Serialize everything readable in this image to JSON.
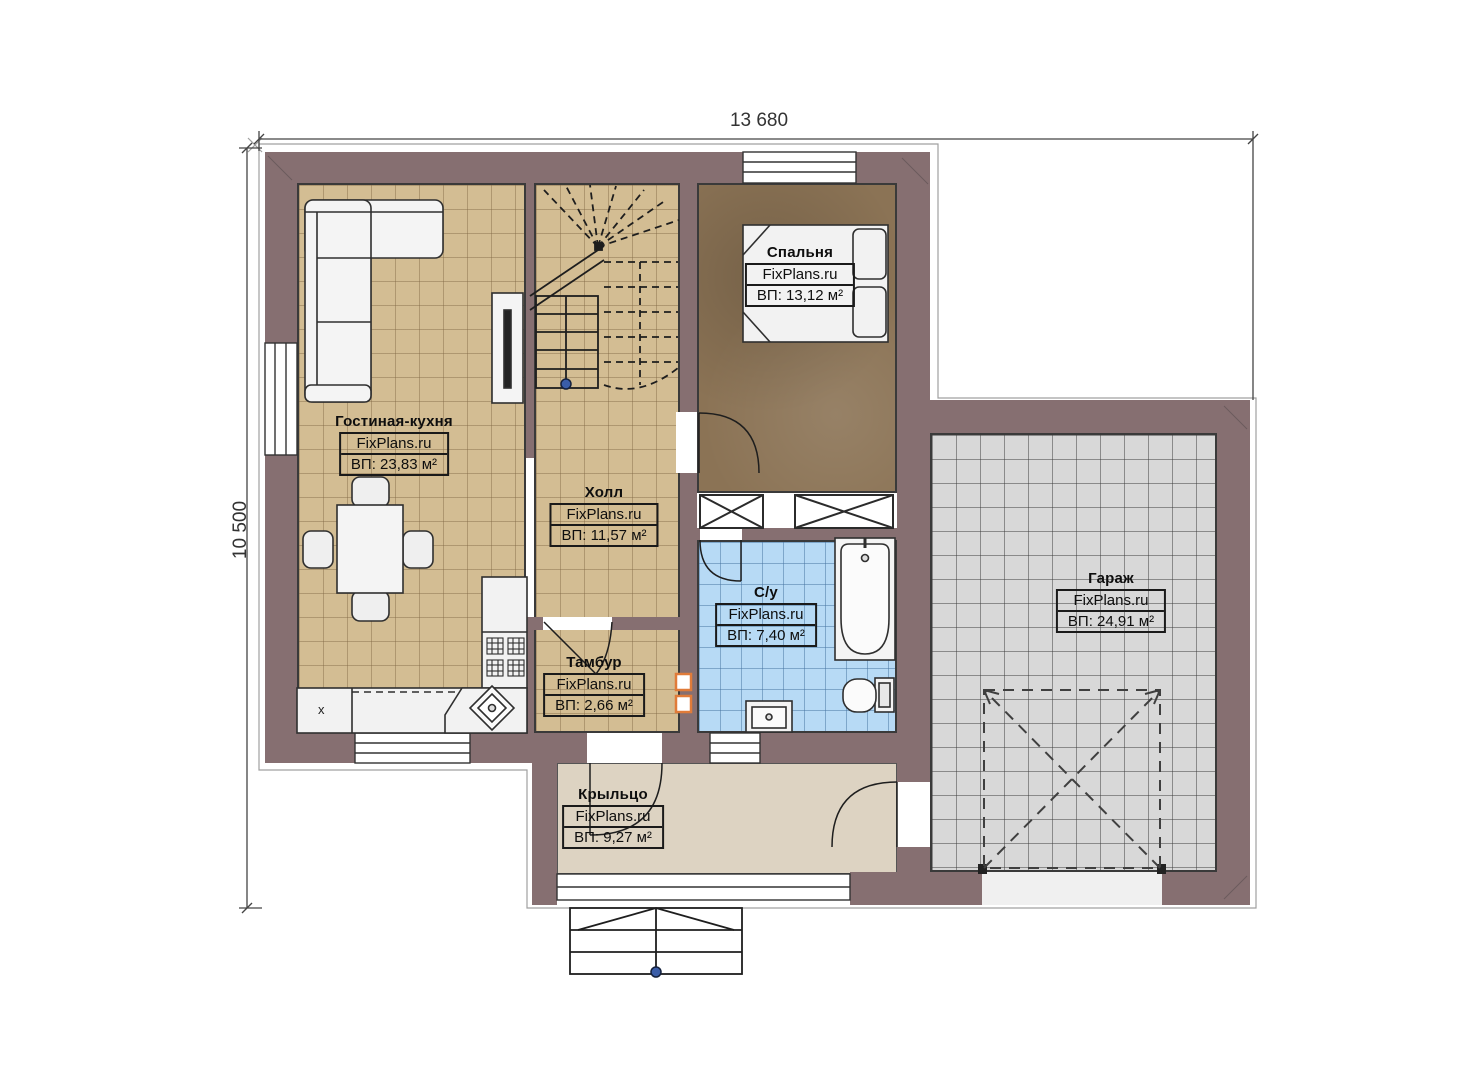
{
  "dimensions": {
    "width_label": "13 680",
    "height_label": "10 500"
  },
  "rooms": [
    {
      "id": "living",
      "name": "Гостиная-кухня",
      "brand": "FixPlans.ru",
      "area": "ВП: 23,83 м²"
    },
    {
      "id": "hall",
      "name": "Холл",
      "brand": "FixPlans.ru",
      "area": "ВП: 11,57 м²"
    },
    {
      "id": "bedroom",
      "name": "Спальня",
      "brand": "FixPlans.ru",
      "area": "ВП: 13,12 м²"
    },
    {
      "id": "bathroom",
      "name": "С/у",
      "brand": "FixPlans.ru",
      "area": "ВП: 7,40 м²"
    },
    {
      "id": "vestibule",
      "name": "Тамбур",
      "brand": "FixPlans.ru",
      "area": "ВП: 2,66 м²"
    },
    {
      "id": "porch",
      "name": "Крыльцо",
      "brand": "FixPlans.ru",
      "area": "ВП: 9,27 м²"
    },
    {
      "id": "garage",
      "name": "Гараж",
      "brand": "FixPlans.ru",
      "area": "ВП: 24,91 м²"
    }
  ],
  "markers": {
    "kitchen_unit": "x"
  },
  "colors": {
    "wall": "#866F71",
    "floor_tan": "#D3BD93",
    "floor_bedroom": "#8B7355",
    "floor_bath": "#B7DAF5",
    "floor_garage": "#D8D8D8",
    "floor_porch": "#DDD3C2",
    "accent_orange": "#E07B39",
    "marker_blue": "#3A5DA8"
  }
}
